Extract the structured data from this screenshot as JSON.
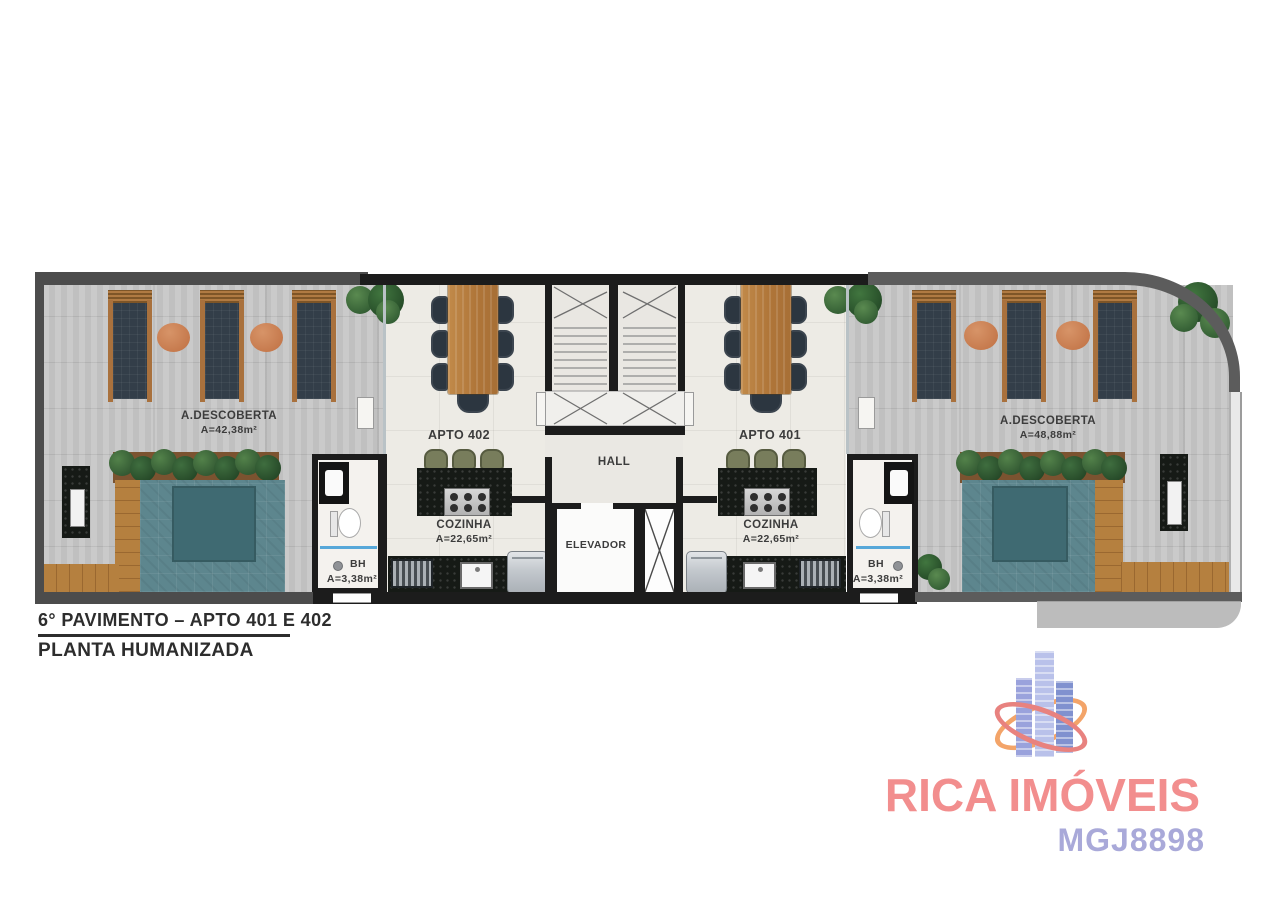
{
  "plan": {
    "deck_left": {
      "label": "A.DESCOBERTA",
      "area": "A=42,38m²"
    },
    "deck_right": {
      "label": "A.DESCOBERTA",
      "area": "A=48,88m²"
    },
    "apto_402": {
      "label": "APTO 402"
    },
    "apto_401": {
      "label": "APTO 401"
    },
    "kitchen_402": {
      "label": "COZINHA",
      "area": "A=22,65m²"
    },
    "kitchen_401": {
      "label": "COZINHA",
      "area": "A=22,65m²"
    },
    "bathroom_left": {
      "label": "BH",
      "area": "A=3,38m²"
    },
    "bathroom_right": {
      "label": "BH",
      "area": "A=3,38m²"
    },
    "hall": {
      "label": "HALL"
    },
    "elevator": {
      "label": "ELEVADOR"
    }
  },
  "caption": {
    "line1": "6° PAVIMENTO – APTO 401 E 402",
    "line2": "PLANTA HUMANIZADA"
  },
  "watermark": {
    "brand": "RICA IMÓVEIS",
    "code": "MGJ8898"
  },
  "colors": {
    "wall": "#1c1c1c",
    "deck": "#c7c7c7",
    "apartment_floor": "#edebe5",
    "pool": "#5d868e",
    "pool_deep": "#3f6a72",
    "wood_deck": "#b5803f",
    "hedge_green": "#2f5a33",
    "side_table": "#c8784f",
    "brand_text": "#f28e8e",
    "code_text": "#a9a9d9",
    "logo_towers": [
      "#9aa2dc",
      "#b9c1ea",
      "#8091cf"
    ],
    "logo_rings": [
      "#f3a469",
      "#e8827f"
    ]
  }
}
